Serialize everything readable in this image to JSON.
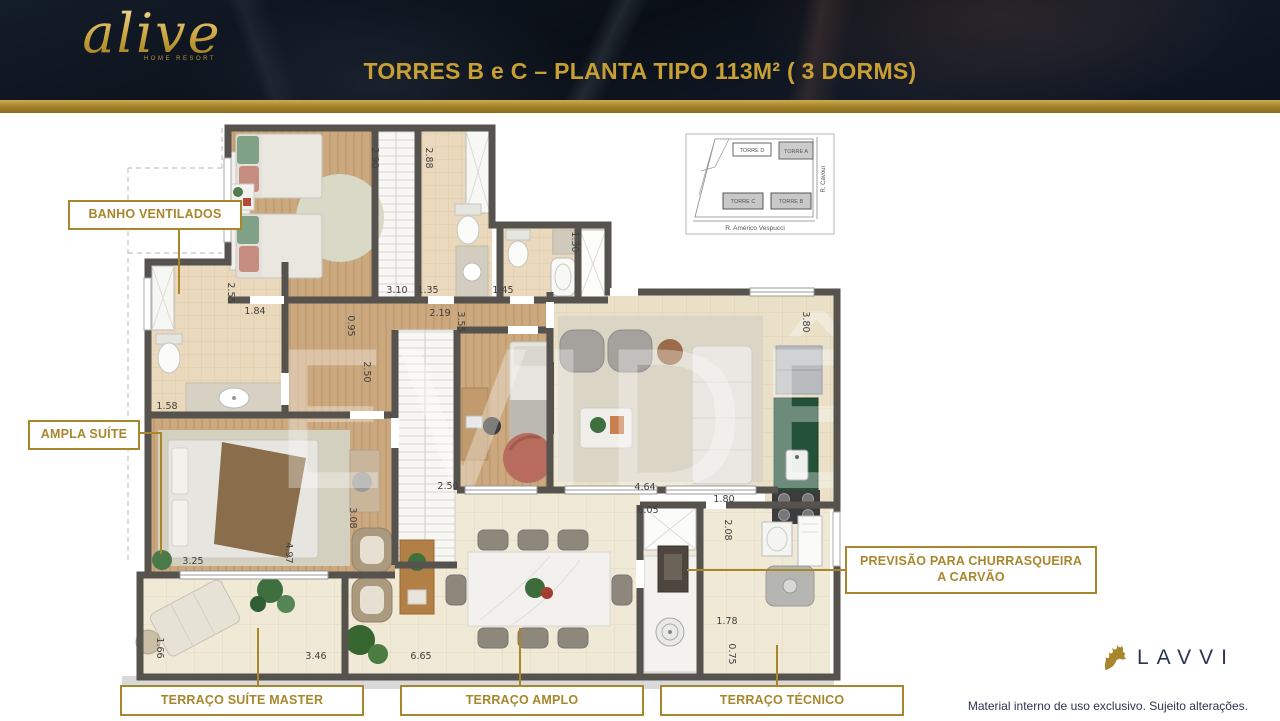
{
  "header": {
    "brand": "alive",
    "brand_tagline": "HOME RESORT",
    "title": "TORRES B e C – PLANTA TIPO 113M² ( 3 DORMS)"
  },
  "site_map": {
    "towers": [
      {
        "label": "TORRE D"
      },
      {
        "label": "TORRE A"
      },
      {
        "label": "TORRE C"
      },
      {
        "label": "TORRE B"
      }
    ],
    "street_right": "R. Cavour",
    "street_bottom": "R. Américo Vespucci"
  },
  "callouts": {
    "banho": "BANHO VENTILADOS",
    "ampla_suite": "AMPLA SUÍTE",
    "previsao": "PREVISÃO PARA CHURRASQUEIRA A CARVÃO",
    "terraco_master": "TERRAÇO SUÍTE MASTER",
    "terraco_amplo": "TERRAÇO AMPLO",
    "terraco_tecnico": "TERRAÇO TÉCNICO"
  },
  "floor_plan": {
    "watermark": "EVIDÊNCIA",
    "dimensions": [
      {
        "v": "2.90",
        "x": 262,
        "y": 38,
        "rot": 90
      },
      {
        "v": "2.88",
        "x": 316,
        "y": 38,
        "rot": 90
      },
      {
        "v": "3.10",
        "x": 287,
        "y": 173
      },
      {
        "v": "1.35",
        "x": 318,
        "y": 173
      },
      {
        "v": "1.45",
        "x": 393,
        "y": 173
      },
      {
        "v": "1.84",
        "x": 145,
        "y": 194
      },
      {
        "v": "2.19",
        "x": 330,
        "y": 196
      },
      {
        "v": "0.95",
        "x": 238,
        "y": 206,
        "rot": 90
      },
      {
        "v": "3.55",
        "x": 348,
        "y": 202,
        "rot": 90
      },
      {
        "v": "1.30",
        "x": 462,
        "y": 122,
        "rot": 90
      },
      {
        "v": "2.55",
        "x": 118,
        "y": 173,
        "rot": 90
      },
      {
        "v": "1.58",
        "x": 57,
        "y": 289
      },
      {
        "v": "2.50",
        "x": 254,
        "y": 252,
        "rot": 90
      },
      {
        "v": "2.50",
        "x": 338,
        "y": 369
      },
      {
        "v": "4.64",
        "x": 535,
        "y": 370
      },
      {
        "v": "6.05",
        "x": 538,
        "y": 393
      },
      {
        "v": "1.80",
        "x": 614,
        "y": 382
      },
      {
        "v": "2.08",
        "x": 615,
        "y": 410,
        "rot": 90
      },
      {
        "v": "3.80",
        "x": 693,
        "y": 202,
        "rot": 90
      },
      {
        "v": "3.08",
        "x": 240,
        "y": 398,
        "rot": 90
      },
      {
        "v": "4.97",
        "x": 176,
        "y": 433,
        "rot": 90
      },
      {
        "v": "3.25",
        "x": 83,
        "y": 444
      },
      {
        "v": "1.66",
        "x": 47,
        "y": 528,
        "rot": 90
      },
      {
        "v": "3.46",
        "x": 206,
        "y": 539
      },
      {
        "v": "6.65",
        "x": 311,
        "y": 539
      },
      {
        "v": "1.78",
        "x": 617,
        "y": 504
      },
      {
        "v": "0.75",
        "x": 619,
        "y": 534,
        "rot": 90
      }
    ]
  },
  "footer": {
    "brand": "LAVVI",
    "disclaimer": "Material interno de uso exclusivo. Sujeito alterações."
  }
}
